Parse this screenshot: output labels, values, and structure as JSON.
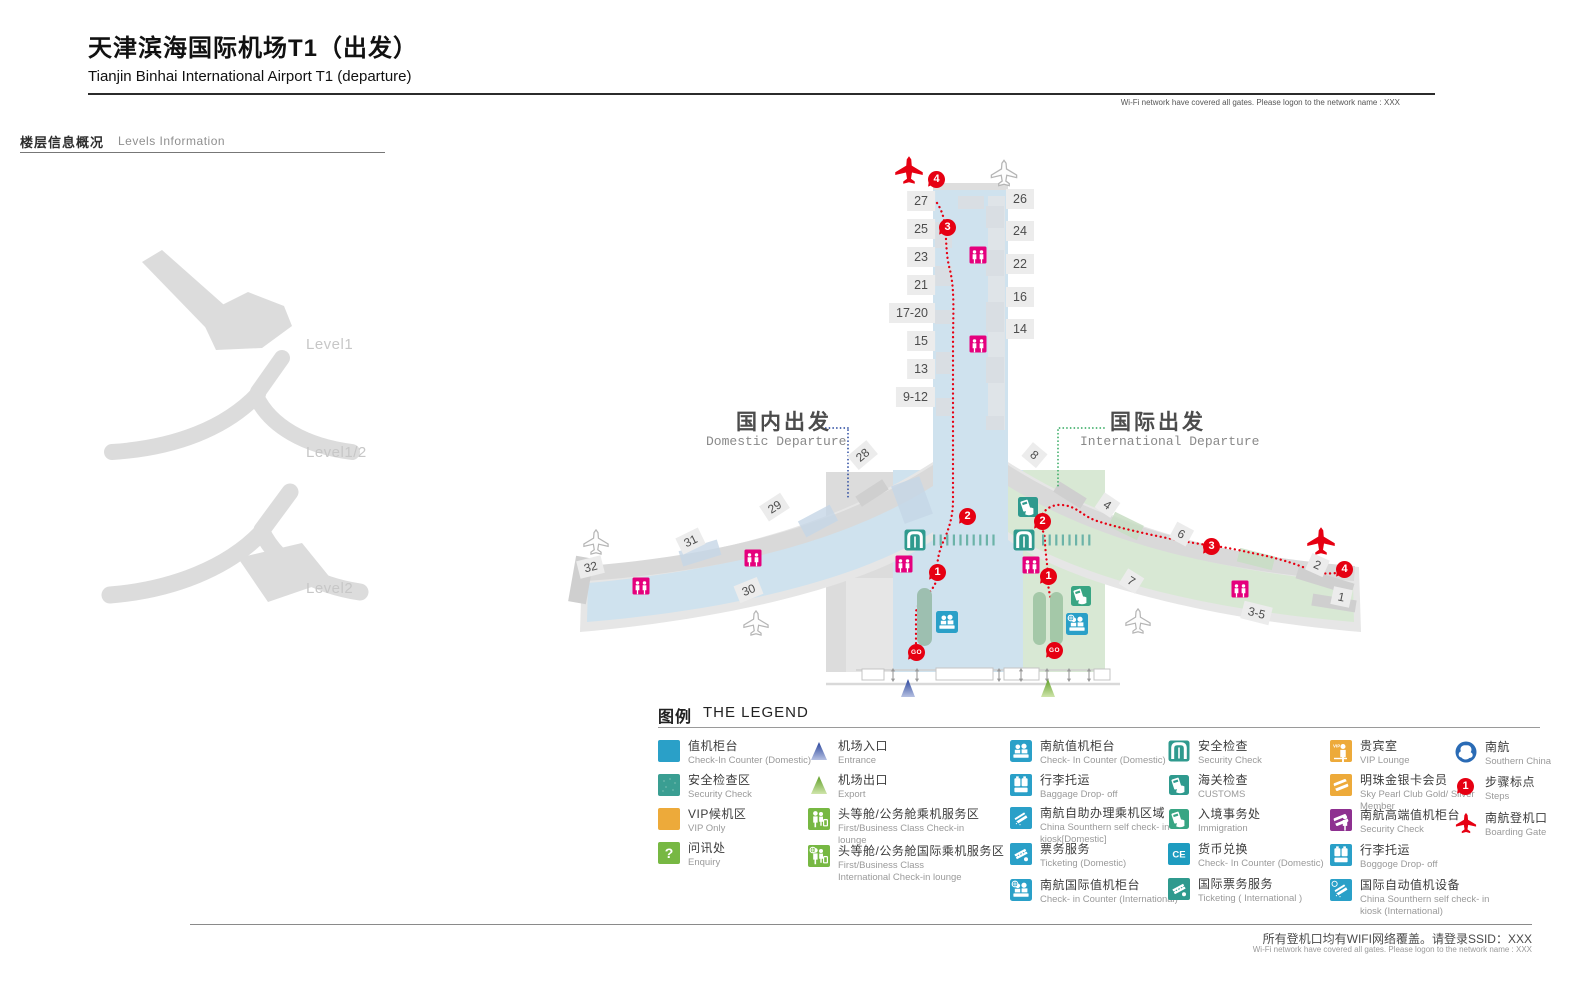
{
  "colors": {
    "route_red": "#e60012",
    "toilet_magenta": "#e5007d",
    "counter_blue": "#2aa0c8",
    "security_teal": "#2f9a8e",
    "immigration_green": "#38a583",
    "service_green": "#77b843",
    "vip_orange": "#edaa3a",
    "premium_purple": "#8e3090",
    "csair_blue": "#2a6bb5",
    "domestic_fill": "#cfe2ee",
    "international_fill": "#d8e8d4"
  },
  "header": {
    "title_zh": "天津滨海国际机场T1（出发）",
    "title_en": "Tianjin Binhai International Airport T1 (departure)",
    "wifi_note": "Wi-Fi network have covered all gates. Please logon to the network name : XXX"
  },
  "levels": {
    "heading_zh": "楼层信息概况",
    "heading_en": "Levels Information",
    "items": [
      {
        "label": "Level1"
      },
      {
        "label": "Level1/2"
      },
      {
        "label": "Level2"
      }
    ]
  },
  "map": {
    "domestic_label": {
      "zh": "国内出发",
      "en": "Domestic Departure"
    },
    "international_label": {
      "zh": "国际出发",
      "en": "International Departure"
    },
    "pier_gates_left": [
      "27",
      "25",
      "23",
      "21",
      "17-20",
      "15",
      "13",
      "9-12"
    ],
    "pier_gates_right": [
      "26",
      "24",
      "22",
      "16",
      "14"
    ],
    "west_gates": [
      "28",
      "29",
      "31",
      "32",
      "30"
    ],
    "east_gates": [
      "8",
      "4",
      "6",
      "7",
      "2",
      "1",
      "3-5"
    ],
    "steps": [
      "1",
      "2",
      "3",
      "4"
    ],
    "go": "GO"
  },
  "legend": {
    "heading_zh": "图例",
    "heading_en": "THE LEGEND",
    "glyphs": {
      "enquiry": "?",
      "ce": "CE",
      "vip": "VIP"
    },
    "items": [
      {
        "zh": "值机柜台",
        "en": "Check-In Counter (Domestic)"
      },
      {
        "zh": "安全检查区",
        "en": "Security Check"
      },
      {
        "zh": "VIP候机区",
        "en": "VIP Only"
      },
      {
        "zh": "问讯处",
        "en": "Enquiry"
      },
      {
        "zh": "机场入口",
        "en": "Entrance"
      },
      {
        "zh": "机场出口",
        "en": "Export"
      },
      {
        "zh": "头等舱/公务舱乘机服务区",
        "en": "First/Business Class Check-in lounge"
      },
      {
        "zh": "头等舱/公务舱国际乘机服务区",
        "en": "First/Business Class International Check-in lounge"
      },
      {
        "zh": "南航值机柜台",
        "en": "Check- In Counter (Domestic)"
      },
      {
        "zh": "行李托运",
        "en": "Baggage Drop- off"
      },
      {
        "zh": "南航自助办理乘机区域",
        "en": "China Sounthern self check- in kiosk[Domestic]"
      },
      {
        "zh": "票务服务",
        "en": "Ticketing (Domestic)"
      },
      {
        "zh": "南航国际值机柜台",
        "en": "Check- in Counter (International)"
      },
      {
        "zh": "安全检查",
        "en": "Security Check"
      },
      {
        "zh": "海关检查",
        "en": "CUSTOMS"
      },
      {
        "zh": "入境事务处",
        "en": "Immigration"
      },
      {
        "zh": "货币兑换",
        "en": "Check- In Counter (Domestic)"
      },
      {
        "zh": "国际票务服务",
        "en": "Ticketing ( International )"
      },
      {
        "zh": "贵宾室",
        "en": "VIP Lounge"
      },
      {
        "zh": "明珠金银卡会员",
        "en": "Sky Pearl Club Gold/ Silver Member"
      },
      {
        "zh": "南航高端值机柜台",
        "en": "Security Check"
      },
      {
        "zh": "行李托运",
        "en": "Boggoge Drop- off"
      },
      {
        "zh": "国际自动值机设备",
        "en": "China Sounthern self check- in kiosk (International)"
      },
      {
        "zh": "南航",
        "en": "Southern China"
      },
      {
        "zh": "步骤标点",
        "en": "Steps"
      },
      {
        "zh": "南航登机口",
        "en": "Boarding Gate"
      }
    ]
  },
  "footer": {
    "note_zh": "所有登机口均有WIFI网络覆盖。请登录SSID：XXX",
    "note_en": "Wi-Fi network have covered all gates. Please logon to the network name : XXX"
  }
}
